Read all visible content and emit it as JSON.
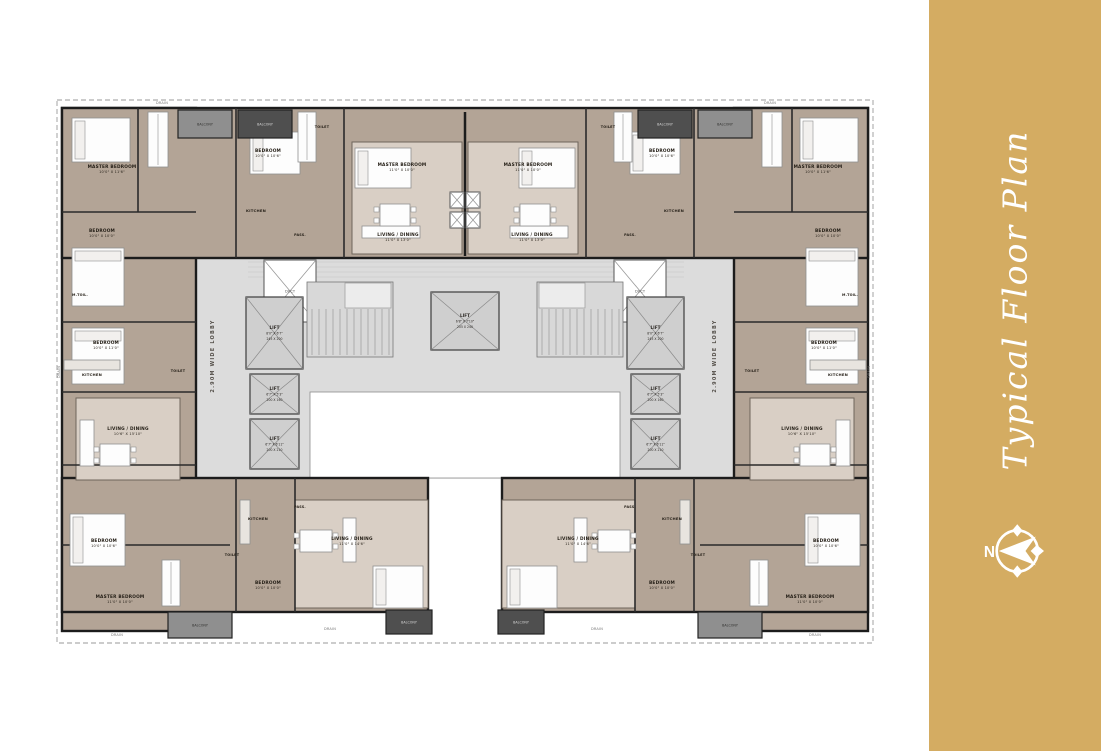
{
  "sidebar": {
    "title": "Typical Floor Plan",
    "compass_n": "N",
    "bg": "#D4AC62",
    "fg": "#FFFFFF"
  },
  "plan": {
    "colors": {
      "apartment": "#B3A496",
      "room_light": "#D9CFC5",
      "lobby": "#DCDCDC",
      "courtyard": "#FFFFFF",
      "lift": "#CFCFCF",
      "stair": "#D8D8D8",
      "balcony_dark": "#4F4F4F",
      "balcony_light": "#8F8F8F",
      "wall": "#1C1C1C",
      "boundary": "#9A9A9A",
      "label": "#262018",
      "lobby_text": "#55504A",
      "furniture_fill": "#FDFDFD",
      "furniture_stroke": "#8F8F8F"
    },
    "mirror_axis": 930,
    "boundary": {
      "x": 57,
      "y": 100,
      "w": 816,
      "h": 543
    },
    "lobby": {
      "x": 196,
      "y": 258,
      "w": 540,
      "h": 220
    },
    "courtyard": {
      "x": 310,
      "y": 392,
      "w": 310,
      "h": 86
    },
    "floor_lines": {
      "ys": [
        262,
        267,
        272,
        277
      ],
      "x1": 248,
      "x2": 684
    },
    "party_wall": {
      "x": 465,
      "y1": 112,
      "y2": 256
    },
    "masses": [
      {
        "x": 62,
        "y": 108,
        "w": 134,
        "h": 523,
        "m": 1
      },
      {
        "x": 62,
        "y": 108,
        "w": 806,
        "h": 150,
        "m": 0
      },
      {
        "x": 62,
        "y": 478,
        "w": 366,
        "h": 134,
        "m": 1
      }
    ],
    "light_rooms": [
      {
        "x": 76,
        "y": 398,
        "w": 104,
        "h": 82,
        "m": 1
      },
      {
        "x": 352,
        "y": 142,
        "w": 110,
        "h": 112,
        "m": 1
      },
      {
        "x": 295,
        "y": 500,
        "w": 133,
        "h": 108,
        "m": 1
      }
    ],
    "ducts": [
      {
        "x": 264,
        "y": 260,
        "w": 52,
        "h": 62,
        "m": 1,
        "label": "DUCT"
      }
    ],
    "small_ducts": [
      {
        "x": 450,
        "y": 192,
        "w": 14,
        "h": 16
      },
      {
        "x": 466,
        "y": 192,
        "w": 14,
        "h": 16
      },
      {
        "x": 450,
        "y": 212,
        "w": 14,
        "h": 16
      },
      {
        "x": 466,
        "y": 212,
        "w": 14,
        "h": 16
      }
    ],
    "lifts": [
      {
        "x": 246,
        "y": 297,
        "w": 57,
        "h": 72,
        "m": 1,
        "lines": [
          "LIFT",
          "8'0\" X 6'7\"",
          "245 X 200"
        ]
      },
      {
        "x": 250,
        "y": 374,
        "w": 49,
        "h": 40,
        "m": 1,
        "lines": [
          "LIFT",
          "6'7\" X 5'3\"",
          "200 X 160"
        ]
      },
      {
        "x": 250,
        "y": 419,
        "w": 49,
        "h": 50,
        "m": 1,
        "lines": [
          "LIFT",
          "6'7\" X 6'11\"",
          "200 X 210"
        ]
      },
      {
        "x": 431,
        "y": 292,
        "w": 68,
        "h": 58,
        "m": 0,
        "lines": [
          "LIFT",
          "6'8\" X 7'10\"",
          "205 X 240"
        ]
      }
    ],
    "stairs": [
      {
        "x": 307,
        "y": 282,
        "w": 86,
        "h": 75,
        "landing": {
          "x": 345,
          "y": 283,
          "w": 46,
          "h": 25
        },
        "m": 1
      }
    ],
    "partitions": [
      {
        "x1": 62,
        "y1": 212,
        "x2": 196,
        "y2": 212,
        "m": 1
      },
      {
        "x1": 62,
        "y1": 322,
        "x2": 196,
        "y2": 322,
        "m": 1
      },
      {
        "x1": 62,
        "y1": 392,
        "x2": 196,
        "y2": 392,
        "m": 1
      },
      {
        "x1": 62,
        "y1": 465,
        "x2": 196,
        "y2": 465,
        "m": 1
      },
      {
        "x1": 138,
        "y1": 108,
        "x2": 138,
        "y2": 212,
        "m": 1
      },
      {
        "x1": 62,
        "y1": 545,
        "x2": 230,
        "y2": 545,
        "m": 1
      },
      {
        "x1": 236,
        "y1": 108,
        "x2": 236,
        "y2": 258,
        "m": 1
      },
      {
        "x1": 344,
        "y1": 108,
        "x2": 344,
        "y2": 258,
        "m": 1
      },
      {
        "x1": 236,
        "y1": 478,
        "x2": 236,
        "y2": 612,
        "m": 1
      },
      {
        "x1": 295,
        "y1": 478,
        "x2": 295,
        "y2": 612,
        "m": 1
      }
    ],
    "furniture": [
      {
        "t": "bed",
        "x": 72,
        "y": 118,
        "w": 58,
        "h": 44,
        "m": 1
      },
      {
        "t": "bed",
        "x": 72,
        "y": 248,
        "w": 52,
        "h": 58,
        "m": 1
      },
      {
        "t": "bed",
        "x": 72,
        "y": 328,
        "w": 52,
        "h": 56,
        "m": 1
      },
      {
        "t": "bed",
        "x": 70,
        "y": 514,
        "w": 55,
        "h": 52,
        "m": 1
      },
      {
        "t": "bed",
        "x": 250,
        "y": 132,
        "w": 50,
        "h": 42,
        "m": 1
      },
      {
        "t": "bed",
        "x": 355,
        "y": 148,
        "w": 56,
        "h": 40,
        "m": 1
      },
      {
        "t": "bed",
        "x": 373,
        "y": 566,
        "w": 50,
        "h": 42,
        "m": 1
      },
      {
        "t": "sofa",
        "x": 80,
        "y": 420,
        "w": 14,
        "h": 46,
        "m": 1
      },
      {
        "t": "sofa",
        "x": 343,
        "y": 518,
        "w": 13,
        "h": 44,
        "m": 1
      },
      {
        "t": "sofa",
        "x": 362,
        "y": 226,
        "w": 58,
        "h": 12,
        "m": 1
      },
      {
        "t": "table",
        "x": 100,
        "y": 444,
        "w": 30,
        "h": 22,
        "m": 1
      },
      {
        "t": "table",
        "x": 380,
        "y": 204,
        "w": 30,
        "h": 22,
        "m": 1
      },
      {
        "t": "table",
        "x": 300,
        "y": 530,
        "w": 32,
        "h": 22,
        "m": 1
      },
      {
        "t": "wardrobe",
        "x": 148,
        "y": 112,
        "w": 20,
        "h": 55,
        "m": 1
      },
      {
        "t": "wardrobe",
        "x": 162,
        "y": 560,
        "w": 18,
        "h": 46,
        "m": 1
      },
      {
        "t": "wardrobe",
        "x": 298,
        "y": 112,
        "w": 18,
        "h": 50,
        "m": 1
      },
      {
        "t": "counter",
        "x": 64,
        "y": 360,
        "w": 56,
        "h": 10,
        "m": 1
      },
      {
        "t": "counter",
        "x": 240,
        "y": 500,
        "w": 10,
        "h": 44,
        "m": 1
      }
    ],
    "balconies": [
      {
        "x": 178,
        "y": 110,
        "w": 54,
        "h": 28,
        "shade": "light",
        "label": "BALCONY",
        "m": 1
      },
      {
        "x": 238,
        "y": 110,
        "w": 54,
        "h": 28,
        "shade": "dark",
        "label": "BALCONY",
        "m": 1
      },
      {
        "x": 168,
        "y": 612,
        "w": 64,
        "h": 26,
        "shade": "light",
        "label": "BALCONY",
        "m": 1
      },
      {
        "x": 386,
        "y": 610,
        "w": 46,
        "h": 24,
        "shade": "dark",
        "label": "BALCONY",
        "m": 1
      }
    ],
    "labels": [
      {
        "t": "MASTER BEDROOM",
        "d": "10'0\" X 11'6\"",
        "x": 112,
        "y": 168,
        "m": 1
      },
      {
        "t": "BEDROOM",
        "d": "10'0\" X 10'0\"",
        "x": 102,
        "y": 232,
        "m": 1
      },
      {
        "t": "M.TOIL.",
        "x": 80,
        "y": 296,
        "s": 3.4,
        "m": 1
      },
      {
        "t": "BEDROOM",
        "d": "10'0\" X 11'0\"",
        "x": 106,
        "y": 344,
        "m": 1
      },
      {
        "t": "KITCHEN",
        "x": 92,
        "y": 376,
        "s": 3.8,
        "m": 1
      },
      {
        "t": "TOILET",
        "x": 178,
        "y": 372,
        "s": 3.4,
        "m": 1
      },
      {
        "t": "LIVING / DINING",
        "d": "10'6\" X 15'10\"",
        "x": 128,
        "y": 430,
        "m": 1
      },
      {
        "t": "BEDROOM",
        "d": "10'0\" X 10'6\"",
        "x": 104,
        "y": 542,
        "m": 1
      },
      {
        "t": "MASTER BEDROOM",
        "d": "11'0\" X 10'0\"",
        "x": 120,
        "y": 598,
        "m": 1
      },
      {
        "t": "BEDROOM",
        "d": "10'0\" X 10'6\"",
        "x": 268,
        "y": 152,
        "m": 1
      },
      {
        "t": "KITCHEN",
        "x": 256,
        "y": 212,
        "s": 3.8,
        "m": 1
      },
      {
        "t": "TOILET",
        "x": 322,
        "y": 128,
        "s": 3.4,
        "m": 1
      },
      {
        "t": "MASTER BEDROOM",
        "d": "11'0\" X 10'0\"",
        "x": 402,
        "y": 166,
        "m": 1
      },
      {
        "t": "LIVING / DINING",
        "d": "11'0\" X 13'0\"",
        "x": 398,
        "y": 236,
        "m": 1
      },
      {
        "t": "PASS.",
        "x": 300,
        "y": 236,
        "s": 3.4,
        "m": 1
      },
      {
        "t": "LIVING / DINING",
        "d": "11'0\" X 14'6\"",
        "x": 352,
        "y": 540,
        "m": 1
      },
      {
        "t": "KITCHEN",
        "x": 258,
        "y": 520,
        "s": 3.8,
        "m": 1
      },
      {
        "t": "TOILET",
        "x": 232,
        "y": 556,
        "s": 3.4,
        "m": 1
      },
      {
        "t": "BEDROOM",
        "d": "10'0\" X 10'0\"",
        "x": 268,
        "y": 584,
        "m": 1
      },
      {
        "t": "PASS.",
        "x": 300,
        "y": 508,
        "s": 3.4,
        "m": 1
      },
      {
        "t": "2.90M WIDE LOBBY",
        "x": 214,
        "y": 356,
        "s": 5,
        "rot": -90,
        "m": 1,
        "lobby": 1
      },
      {
        "t": "DRAIN",
        "x": 162,
        "y": 104,
        "s": 3.5,
        "drain": 1
      },
      {
        "t": "DRAIN",
        "x": 770,
        "y": 104,
        "s": 3.5,
        "drain": 1
      },
      {
        "t": "DRAIN",
        "x": 117,
        "y": 636,
        "s": 3.5,
        "drain": 1
      },
      {
        "t": "DRAIN",
        "x": 330,
        "y": 630,
        "s": 3.5,
        "drain": 1
      },
      {
        "t": "DRAIN",
        "x": 597,
        "y": 630,
        "s": 3.5,
        "drain": 1
      },
      {
        "t": "DRAIN",
        "x": 815,
        "y": 636,
        "s": 3.5,
        "drain": 1
      },
      {
        "t": "DRAIN",
        "x": 60,
        "y": 372,
        "s": 3.5,
        "rot": -90,
        "drain": 1
      },
      {
        "t": "DRAIN",
        "x": 870,
        "y": 372,
        "s": 3.5,
        "rot": -90,
        "drain": 1
      }
    ]
  }
}
